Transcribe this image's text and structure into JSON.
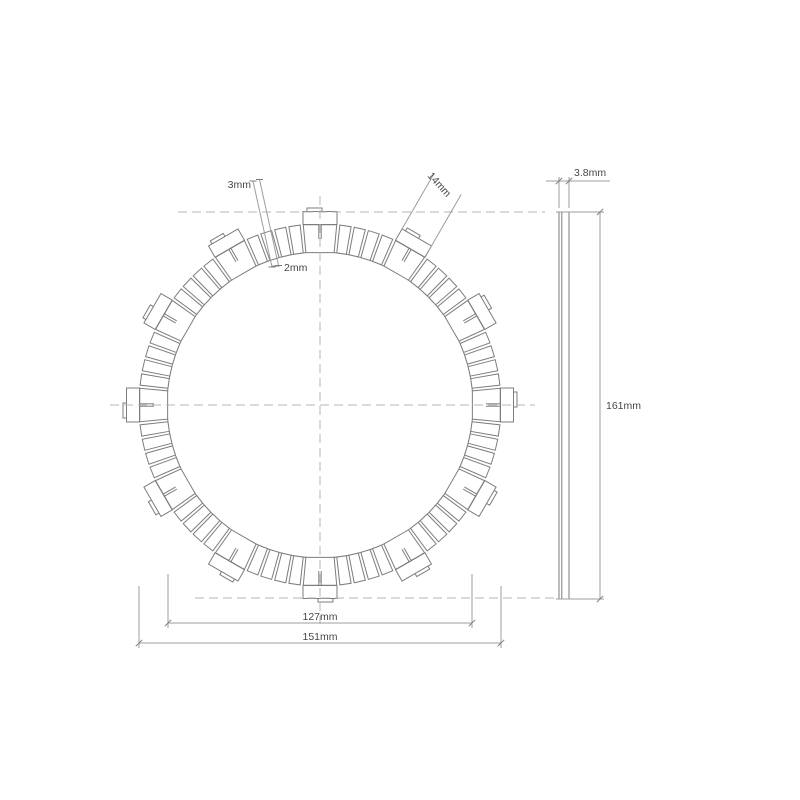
{
  "drawing": {
    "title": "clutch friction plate technical drawing",
    "colors": {
      "part_line": "#7d7d7d",
      "dimension_line": "#9d9d9d",
      "centerline": "#b5b5b5",
      "text": "#474747",
      "background": "#ffffff"
    },
    "front_view": {
      "cx": 320,
      "cy": 405,
      "ring_inner_radius": 153,
      "ring_outer_radius": 181,
      "tab_outer_radius": 193.5,
      "tab_half_width": 17,
      "tab_step_outer_radius": 197,
      "tab_step_offset": -13,
      "tab_step_width": 15,
      "tab_count": 12,
      "tab_pad_half_angle_deg": 5.3,
      "stem_inner_radius": 166,
      "stem_half_px": 1.2,
      "pads_between_tabs": 4,
      "pad_start_offset_deg": 6.3,
      "pad_pitch_deg": 4.6,
      "pad_angle_deg": 3.6
    },
    "side_view": {
      "left": 559,
      "right": 569,
      "top": 212,
      "bottom": 599,
      "layer_line_x": 561.8
    },
    "centerlines": [
      [
        178,
        212,
        545,
        212
      ],
      [
        195,
        598,
        557,
        598
      ],
      [
        320,
        196,
        320,
        624
      ],
      [
        110,
        405,
        535,
        405
      ]
    ],
    "dimensions": [
      {
        "id": "thickness",
        "label": "3.8mm",
        "ext": [
          [
            559,
            208,
            559,
            177
          ],
          [
            569,
            208,
            569,
            177
          ]
        ],
        "line": [
          546,
          181,
          610,
          181
        ],
        "ticks": [
          [
            559,
            181
          ],
          [
            569,
            181
          ]
        ],
        "tick_style": "slash"
      },
      {
        "id": "overall-diameter",
        "label": "161mm",
        "ext": [
          [
            556,
            212,
            604,
            212
          ],
          [
            556,
            599,
            604,
            599
          ]
        ],
        "line": [
          600,
          212,
          600,
          599
        ],
        "ticks": [
          [
            600,
            212
          ],
          [
            600,
            599
          ]
        ],
        "tick_style": "slash"
      },
      {
        "id": "inner-diameter",
        "label": "127mm",
        "ext": [
          [
            168,
            574,
            168,
            628
          ],
          [
            472,
            574,
            472,
            628
          ]
        ],
        "line": [
          168,
          623,
          472,
          623
        ],
        "ticks": [
          [
            168,
            623
          ],
          [
            472,
            623
          ]
        ],
        "tick_style": "slash"
      },
      {
        "id": "friction-outer-diameter",
        "label": "151mm",
        "ext": [
          [
            139,
            586,
            139,
            648
          ],
          [
            501,
            586,
            501,
            648
          ]
        ],
        "line": [
          139,
          643,
          501,
          643
        ],
        "ticks": [
          [
            139,
            643
          ],
          [
            501,
            643
          ]
        ],
        "tick_style": "slash"
      },
      {
        "id": "groove-width-outer",
        "label": "3mm",
        "ext": [
          [
            253,
            181,
            272,
            267
          ],
          [
            259.5,
            179.5,
            278.5,
            265.5
          ]
        ],
        "line": null,
        "ticks": [
          [
            253,
            181
          ],
          [
            259.5,
            179.5
          ],
          [
            272,
            267
          ],
          [
            278.5,
            265.5
          ]
        ],
        "tick_style": "h"
      },
      {
        "id": "groove-width-inner",
        "label": "2mm",
        "ext": [],
        "line": null,
        "ticks": [
          [
            276,
            266
          ]
        ],
        "tick_style": "h"
      },
      {
        "id": "tab-width",
        "label": "14mm",
        "ext": [
          [
            401.8,
            229.4,
            434.3,
            173.1
          ],
          [
            428.7,
            250.7,
            461.2,
            194.4
          ]
        ],
        "line": null,
        "ticks": [],
        "tick_style": "none"
      }
    ]
  }
}
